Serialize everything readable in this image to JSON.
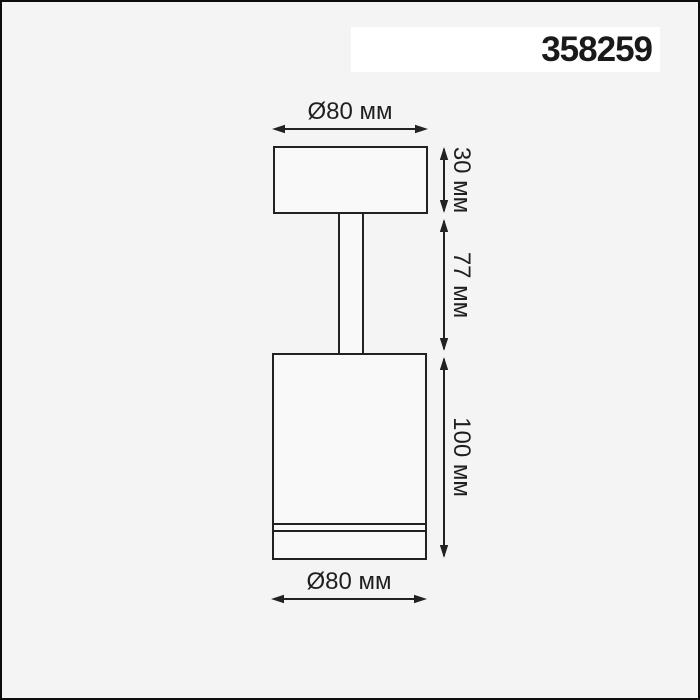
{
  "header": {
    "model_number": "358259"
  },
  "dimensions": {
    "top_diameter": "Ø80 мм",
    "bottom_diameter": "Ø80 мм",
    "base_height": "30 мм",
    "stem_height": "77 мм",
    "body_height": "100 мм"
  },
  "colors": {
    "page_background": "#f4f4f4",
    "badge_background": "#ffffff",
    "line_color": "#222222",
    "text_color": "#1f1f1f"
  }
}
